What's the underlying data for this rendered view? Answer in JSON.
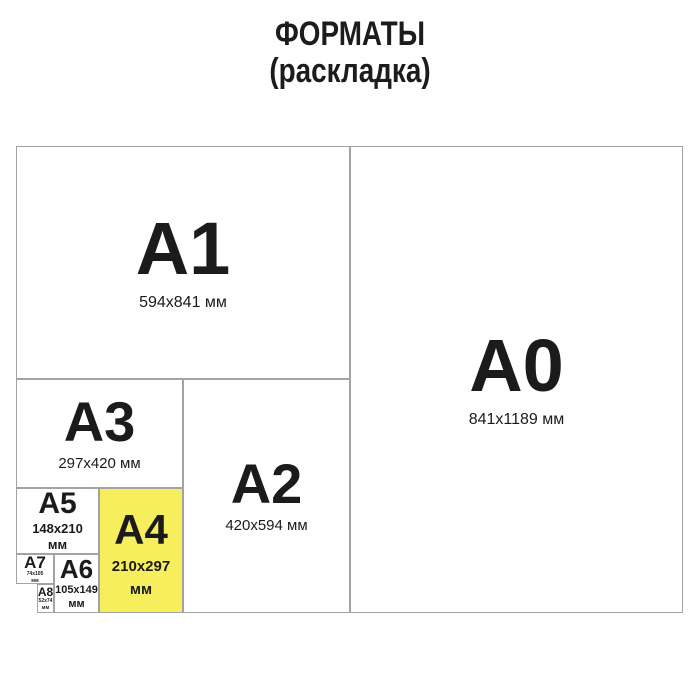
{
  "title": {
    "line1": "ФОРМАТЫ",
    "line2": "(раскладка)"
  },
  "colors": {
    "highlight": "#f7ee5d",
    "border": "#a3a3a3",
    "text": "#1b1b1b",
    "background": "#ffffff"
  },
  "formats": {
    "a0": {
      "label": "A0",
      "size": "841x1189 мм"
    },
    "a1": {
      "label": "A1",
      "size": "594x841 мм"
    },
    "a2": {
      "label": "A2",
      "size": "420x594 мм"
    },
    "a3": {
      "label": "A3",
      "size": "297x420 мм"
    },
    "a4": {
      "label": "A4",
      "size": "210x297",
      "unit": "мм",
      "highlighted": true
    },
    "a5": {
      "label": "A5",
      "size": "148x210",
      "unit": "мм"
    },
    "a6": {
      "label": "A6",
      "size": "105x149",
      "unit": "мм"
    },
    "a7": {
      "label": "A7",
      "size": "74x105",
      "unit": "мм"
    },
    "a8": {
      "label": "A8",
      "size": "52x74",
      "unit": "мм"
    }
  }
}
